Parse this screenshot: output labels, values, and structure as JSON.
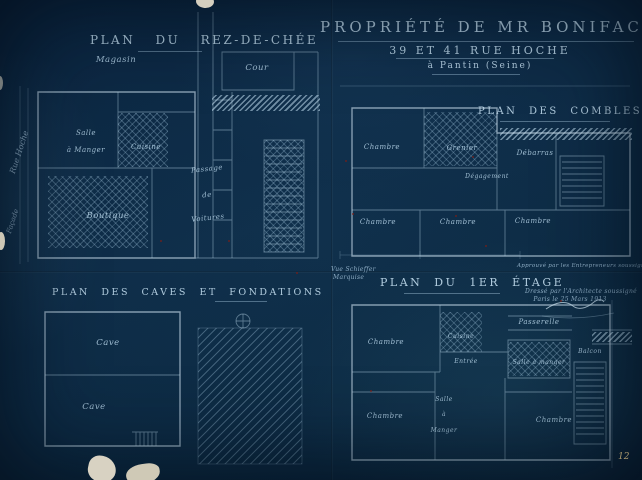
{
  "sheet": {
    "title": {
      "line1": "Propriété de Mr Bonifacy",
      "line2": "39 et 41 Rue Hoche",
      "line3": "à Pantin (Seine)"
    },
    "page_number": "12",
    "street_labels": {
      "rue": "Rue Hoche",
      "facade": "Façade"
    },
    "annotations": {
      "approved": "Approuvé par les Entrepreneurs soussignés",
      "drafted_line1": "Dressé par l'Architecte soussigné",
      "drafted_line2": "Paris le 25 Mars 1913",
      "note_line1": "Vue Schieffer",
      "note_line2": "Marquise"
    }
  },
  "plans": {
    "rdc": {
      "title": "Plan du Rez-de-Chée",
      "labels": {
        "magasin": "Magasin",
        "cour": "Cour",
        "salle": "Salle",
        "a_manger": "à Manger",
        "cuisine": "Cuisine",
        "passage": "Passage",
        "de": "de",
        "voitures": "Voitures",
        "boutique": "Boutique"
      }
    },
    "combles": {
      "title": "Plan des Combles",
      "labels": {
        "chambre_nw": "Chambre",
        "grenier": "Grenier",
        "debarras": "Débarras",
        "degagement": "Dégagement",
        "chambre_sw": "Chambre",
        "chambre_s": "Chambre",
        "chambre_se": "Chambre"
      }
    },
    "caves": {
      "title": "Plan des Caves et Fondations",
      "labels": {
        "cave_haut": "Cave",
        "cave_bas": "Cave"
      }
    },
    "etage1": {
      "title": "Plan du 1er Étage",
      "labels": {
        "passerelle": "Passerelle",
        "chambre_nw": "Chambre",
        "cuisine": "Cuisine",
        "entree": "Entrée",
        "salle_hachuree": "Salle à manger",
        "balcon": "Balcon",
        "chambre_sw": "Chambre",
        "salle": "Salle",
        "a": "à",
        "manger": "Manger",
        "chambre_se": "Chambre"
      }
    }
  }
}
